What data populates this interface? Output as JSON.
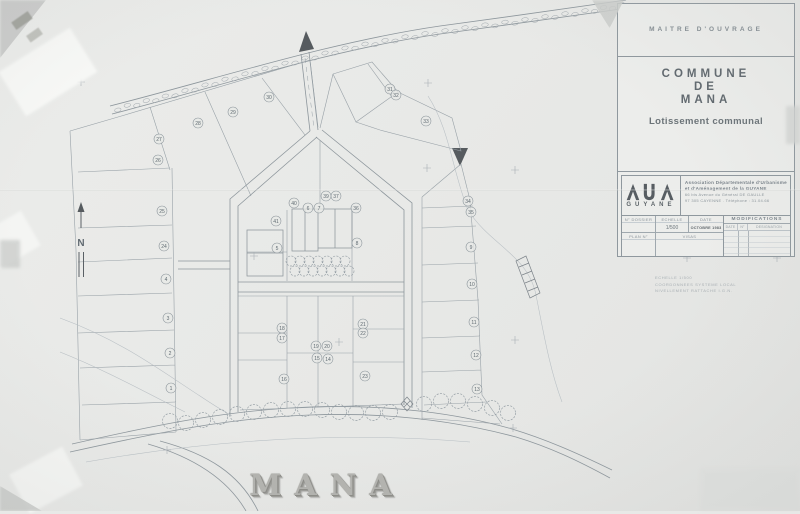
{
  "title_block": {
    "maitre_douvrage": "MAITRE   D'OUVRAGE",
    "commune": [
      "COMMUNE",
      "DE",
      "MANA"
    ],
    "subtitle": "Lotissement communal",
    "logo_text": "GUYANE",
    "association_lines": [
      "Association  Départementale  d'Urbanisme",
      "et  d'Aménagement  de  la  GUYANE",
      "66 bis  Avenue  du  Général  DE GAULLE",
      "97 305  CAYENNE .  Téléphone : 31.04.66"
    ],
    "table": {
      "no_dossier": "N° DOSSIER",
      "echelle": "ECHELLE",
      "echelle_value": "1/500",
      "date": "DATE",
      "date_value": "OCTOBRE 1983",
      "modifications": "MODIFICATIONS",
      "mod_date": "DATE",
      "mod_no": "N°",
      "mod_designation": "DESIGNATION",
      "plan_no": "PLAN N°",
      "visas": "VISAS"
    }
  },
  "notes": {
    "line1": "ECHELLE  1/500",
    "line2": "COORDONNEES  SYSTEME  LOCAL",
    "line3": "NIVELLEMENT  RATTACHE  I.G.N."
  },
  "footer": {
    "title": "MANA"
  },
  "plan": {
    "north_label": "N",
    "lots": [
      {
        "n": "1",
        "x": 171,
        "y": 388
      },
      {
        "n": "2",
        "x": 170,
        "y": 353
      },
      {
        "n": "3",
        "x": 168,
        "y": 318
      },
      {
        "n": "4",
        "x": 166,
        "y": 279
      },
      {
        "n": "5",
        "x": 277,
        "y": 248
      },
      {
        "n": "6",
        "x": 308,
        "y": 208
      },
      {
        "n": "7",
        "x": 319,
        "y": 208
      },
      {
        "n": "8",
        "x": 357,
        "y": 243
      },
      {
        "n": "9",
        "x": 471,
        "y": 247
      },
      {
        "n": "10",
        "x": 472,
        "y": 284
      },
      {
        "n": "11",
        "x": 474,
        "y": 322
      },
      {
        "n": "12",
        "x": 476,
        "y": 355
      },
      {
        "n": "13",
        "x": 477,
        "y": 389
      },
      {
        "n": "14",
        "x": 328,
        "y": 359
      },
      {
        "n": "15",
        "x": 317,
        "y": 358
      },
      {
        "n": "16",
        "x": 284,
        "y": 379
      },
      {
        "n": "17",
        "x": 282,
        "y": 338
      },
      {
        "n": "18",
        "x": 282,
        "y": 328
      },
      {
        "n": "19",
        "x": 316,
        "y": 346
      },
      {
        "n": "20",
        "x": 327,
        "y": 346
      },
      {
        "n": "21",
        "x": 363,
        "y": 324
      },
      {
        "n": "22",
        "x": 363,
        "y": 333
      },
      {
        "n": "23",
        "x": 365,
        "y": 376
      },
      {
        "n": "24",
        "x": 164,
        "y": 246
      },
      {
        "n": "25",
        "x": 162,
        "y": 211
      },
      {
        "n": "26",
        "x": 158,
        "y": 160
      },
      {
        "n": "27",
        "x": 159,
        "y": 139
      },
      {
        "n": "28",
        "x": 198,
        "y": 123
      },
      {
        "n": "29",
        "x": 233,
        "y": 112
      },
      {
        "n": "30",
        "x": 269,
        "y": 97
      },
      {
        "n": "31",
        "x": 390,
        "y": 89
      },
      {
        "n": "32",
        "x": 396,
        "y": 95
      },
      {
        "n": "33",
        "x": 426,
        "y": 121
      },
      {
        "n": "34",
        "x": 468,
        "y": 201
      },
      {
        "n": "35",
        "x": 471,
        "y": 212
      },
      {
        "n": "36",
        "x": 356,
        "y": 208
      },
      {
        "n": "37",
        "x": 336,
        "y": 196
      },
      {
        "n": "39",
        "x": 326,
        "y": 196
      },
      {
        "n": "40",
        "x": 294,
        "y": 203
      },
      {
        "n": "41",
        "x": 276,
        "y": 221
      }
    ],
    "trees_central": [
      [
        291,
        261
      ],
      [
        300,
        261
      ],
      [
        309,
        261
      ],
      [
        318,
        261
      ],
      [
        327,
        261
      ],
      [
        336,
        261
      ],
      [
        345,
        261
      ],
      [
        295,
        271
      ],
      [
        304,
        271
      ],
      [
        313,
        271
      ],
      [
        322,
        271
      ],
      [
        331,
        271
      ],
      [
        340,
        271
      ],
      [
        349,
        271
      ]
    ],
    "trees_bottom": [
      [
        170,
        421
      ],
      [
        186,
        423
      ],
      [
        203,
        420
      ],
      [
        220,
        417
      ],
      [
        237,
        414
      ],
      [
        254,
        412
      ],
      [
        271,
        410
      ],
      [
        288,
        409
      ],
      [
        305,
        409
      ],
      [
        322,
        410
      ],
      [
        339,
        412
      ],
      [
        356,
        413
      ],
      [
        373,
        413
      ],
      [
        390,
        412
      ],
      [
        424,
        404
      ],
      [
        441,
        401
      ],
      [
        458,
        401
      ],
      [
        475,
        404
      ],
      [
        492,
        408
      ],
      [
        508,
        413
      ]
    ],
    "crosses": [
      [
        81,
        82
      ],
      [
        428,
        83
      ],
      [
        427,
        168
      ],
      [
        515,
        170
      ],
      [
        254,
        256
      ],
      [
        339,
        342
      ],
      [
        515,
        340
      ],
      [
        513,
        428
      ],
      [
        687,
        258
      ],
      [
        777,
        258
      ],
      [
        167,
        450
      ]
    ]
  }
}
